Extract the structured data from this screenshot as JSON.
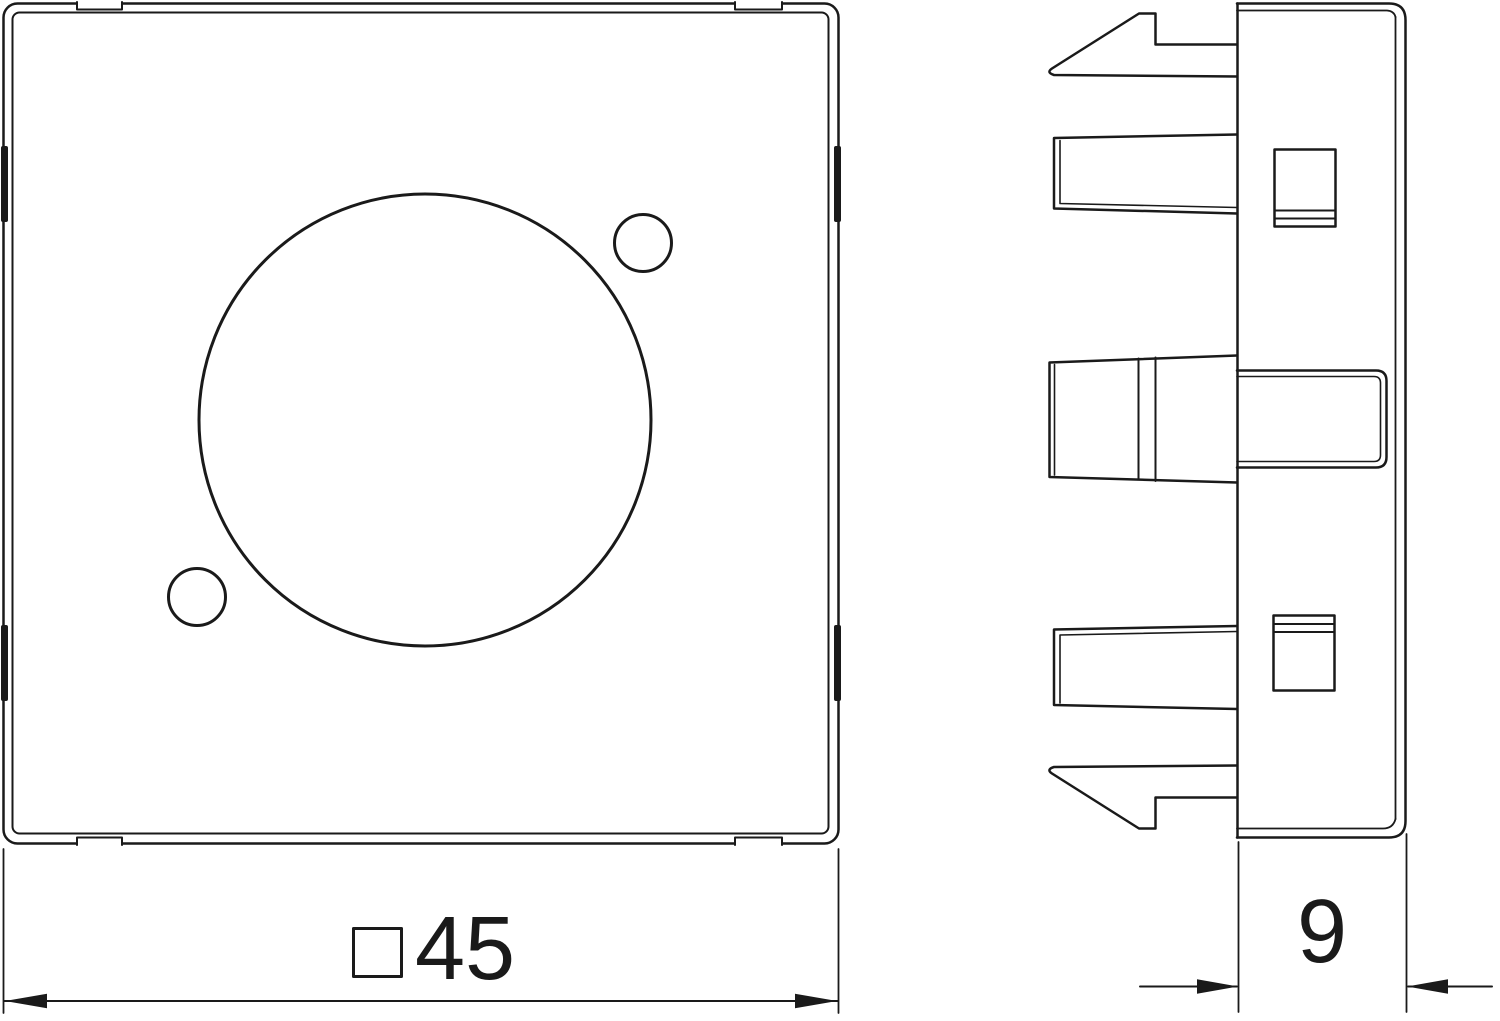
{
  "drawing": {
    "background": "#ffffff",
    "line_color": "#1a1a1a",
    "dimensions": {
      "width": {
        "symbol": "□",
        "value": "45"
      },
      "depth": {
        "value": "9"
      }
    }
  }
}
